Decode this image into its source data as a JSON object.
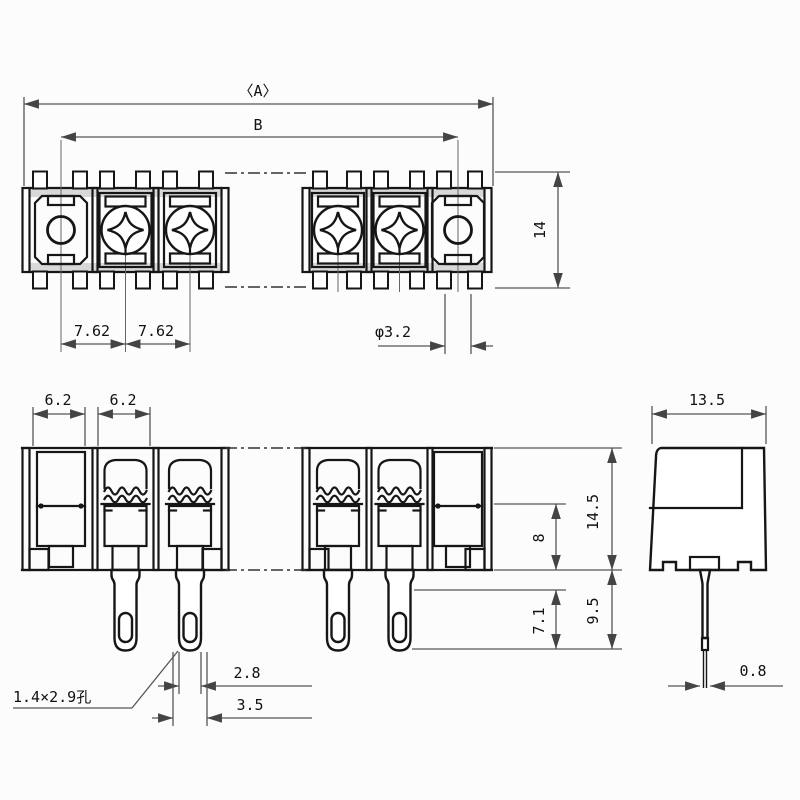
{
  "drawing": {
    "kind": "terminal-block-dimension-drawing",
    "ink_color": "#161616",
    "dim_line_color": "#555555",
    "paper_color": "#fcfcfc",
    "top_view": {
      "overall_width": "〈A〉",
      "mount_hole_span": "B",
      "body_depth": "14",
      "pitch1": "7.62",
      "pitch2": "7.62",
      "mount_hole_dia": "φ3.2"
    },
    "front_view": {
      "cell_width1": "6.2",
      "cell_width2": "6.2",
      "body_height": "14.5",
      "clamp_depth": "8",
      "pin_length": "9.5",
      "pin_hole_span": "7.1",
      "pin_width": "2.8",
      "pin_flare_width": "3.5",
      "pin_hole_note": "1.4×2.9孔"
    },
    "side_view": {
      "body_depth": "13.5",
      "pin_thickness": "0.8"
    }
  }
}
